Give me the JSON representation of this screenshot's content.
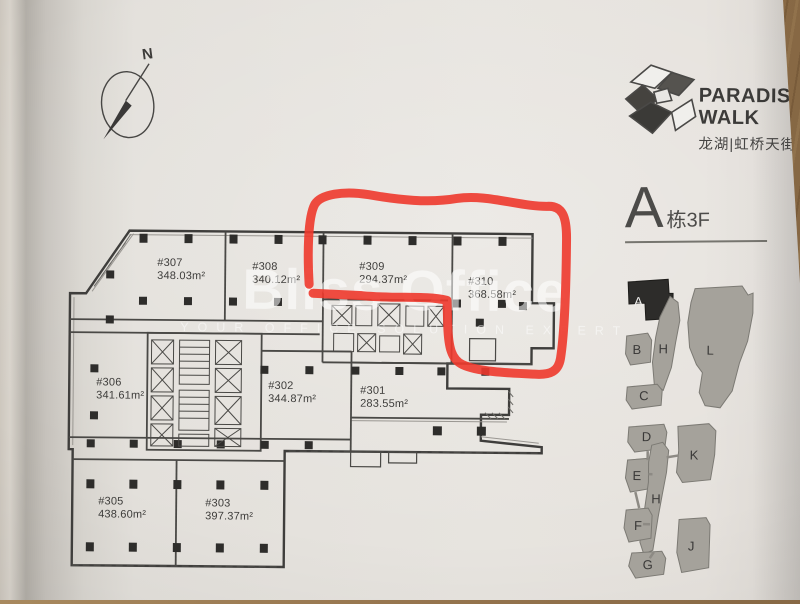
{
  "compass": {
    "label": "N"
  },
  "logo": {
    "line1": "PARADISE",
    "line2": "WALK",
    "line3": "龙湖|虹桥天街"
  },
  "heading": {
    "building": "A",
    "floor": "栋3F"
  },
  "watermark": {
    "title": "Bliss Office",
    "tagline": "YOUR OFFICE SOLUTION EXPERT"
  },
  "plan": {
    "rooms": [
      {
        "id": "#307",
        "area": "348.03m²"
      },
      {
        "id": "#308",
        "area": "340.12m²"
      },
      {
        "id": "#309",
        "area": "294.37m²"
      },
      {
        "id": "#310",
        "area": "368.58m²"
      },
      {
        "id": "#306",
        "area": "341.61m²"
      },
      {
        "id": "#302",
        "area": "344.87m²"
      },
      {
        "id": "#301",
        "area": "283.55m²"
      },
      {
        "id": "#305",
        "area": "438.60m²"
      },
      {
        "id": "#303",
        "area": "397.37m²"
      }
    ],
    "highlighted_rooms": [
      "#309",
      "#310"
    ]
  },
  "keyplan": {
    "blocks": [
      {
        "label": "A",
        "highlighted": true
      },
      {
        "label": "B"
      },
      {
        "label": "H"
      },
      {
        "label": "L"
      },
      {
        "label": "C"
      },
      {
        "label": "D"
      },
      {
        "label": "K"
      },
      {
        "label": "E"
      },
      {
        "label": "H"
      },
      {
        "label": "F"
      },
      {
        "label": "J"
      },
      {
        "label": "G"
      }
    ]
  },
  "colors": {
    "marker": "#ee382c",
    "keyplan_highlight": "#2d2c2a",
    "keyplan_block": "#a5a29b",
    "paper": "#e4e1dc",
    "wood": "#96754e"
  }
}
